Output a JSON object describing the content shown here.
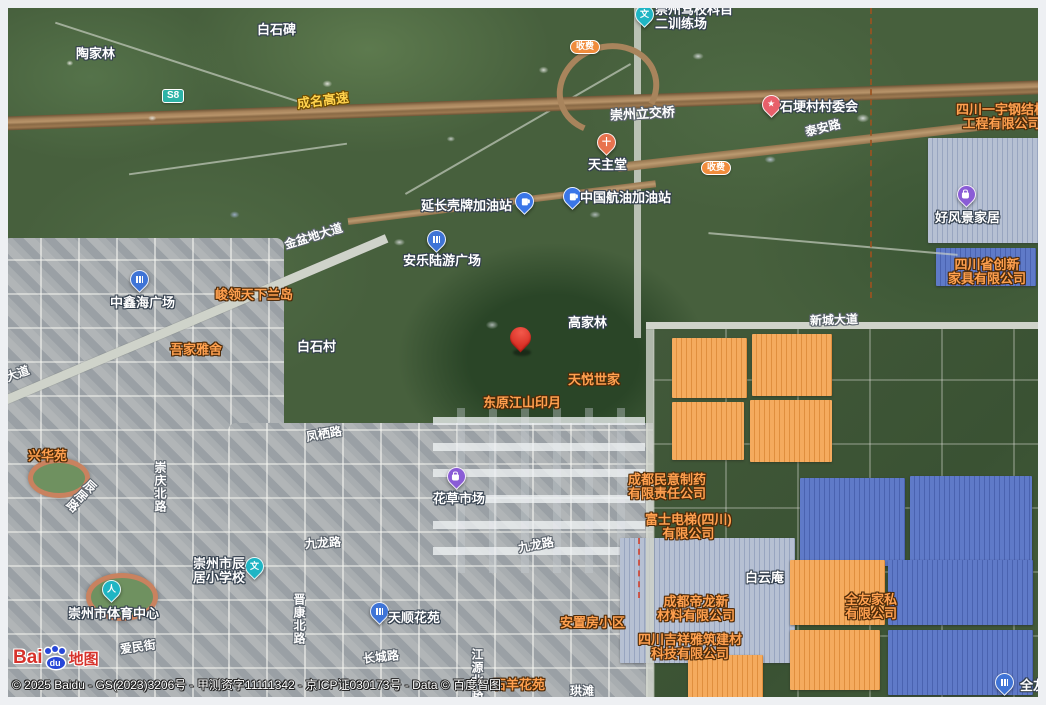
{
  "shield": "S8",
  "toll": "收费",
  "icons": {
    "education_glyph": "文",
    "star_glyph": "★",
    "church_glyph": "十",
    "sports_glyph": "人"
  },
  "roads": {
    "chengming_expwy": "成名高速",
    "chengming_expwy_partial": "成名高速",
    "lijiaoqiao": "崇州立交桥",
    "taian": "泰安路",
    "jinpendi": "金盆地大道",
    "jinpendi_partial": "盆地大道",
    "xincheng": "新城大道",
    "fengqi": "凤栖路",
    "chongqing_n": "崇庆北路",
    "jiulong_w": "九龙路",
    "jiulong_c": "九龙路",
    "aimin": "爱民街",
    "jinkang_n": "晋康北路",
    "changcheng": "长城路",
    "jiangyuan_n": "江源北路",
    "chenju": "辰居路",
    "gongtan": "珙滩"
  },
  "labels": {
    "taojialin": "陶家林",
    "baishibei": "白石碑",
    "gaojialin": "高家林",
    "baishicun": "白石村",
    "baiyunan": "白云庵",
    "xinghuayuan": "兴华苑",
    "junling": "峻领天下兰岛",
    "wujia": "吾家雅舍",
    "tianyue": "天悦世家",
    "dongyuan": "东原江山印月",
    "anzhifang": "安置房小区",
    "shiyang": "石羊花苑"
  },
  "pois": {
    "jiaxiao": {
      "l1": "崇州驾校科目",
      "l2": "二训练场"
    },
    "tianzhutang": "天主堂",
    "shigengcun": "石埂村村委会",
    "yanchang": "延长壳牌加油站",
    "hangyou": "中国航油加油站",
    "haofengjing": "好风景家居",
    "zhongxinhai": "中鑫海广场",
    "anle": "安乐陆游广场",
    "huacao": "花草市场",
    "chenju_school": {
      "l1": "崇州市辰",
      "l2": "居小学校"
    },
    "tiyu": "崇州市体育中心",
    "tianshun": "天顺花苑",
    "quanyou_pin": "全友"
  },
  "companies": {
    "yiyu": {
      "l1": "四川一宇钢结构",
      "l2": "工程有限公司"
    },
    "chuangxin": {
      "l1": "四川省创新",
      "l2": "家具有限公司"
    },
    "minyi": {
      "l1": "成都民意制药",
      "l2": "有限责任公司"
    },
    "fushi": {
      "l1": "富士电梯(四川)",
      "l2": "有限公司"
    },
    "dilong": {
      "l1": "成都帝龙新",
      "l2": "材料有限公司"
    },
    "jixiang": {
      "l1": "四川吉祥雅筑建材",
      "l2": "科技有限公司"
    },
    "quanyou": {
      "l1": "全友家私",
      "l2": "有限公司"
    }
  },
  "attribution": {
    "logo_bai": "Bai",
    "logo_du": "du",
    "logo_map": "地图",
    "copyright": "© 2025 Baidu - GS(2023)3206号 - 甲测资字11111342 - 京ICP证030173号 - Data © 百度智图"
  }
}
